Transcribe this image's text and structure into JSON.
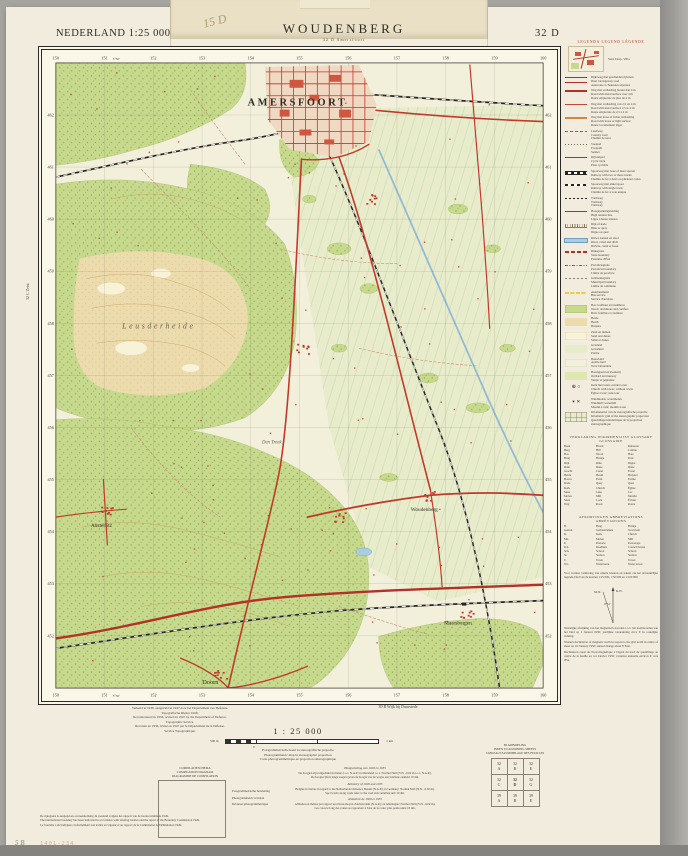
{
  "page": {
    "stamp": "1401-234",
    "pencil_mark": "5 B"
  },
  "header": {
    "series": "NEDERLAND 1:25 000",
    "title": "WOUDENBERG",
    "subtitle": "32 D  Amersfoort",
    "sheet": "32 D",
    "scribble": "15 D"
  },
  "map": {
    "grid_top": [
      "150",
      "151",
      "152",
      "153",
      "154",
      "155",
      "156",
      "157",
      "158",
      "159",
      "160"
    ],
    "grid_left": [
      "462",
      "461",
      "460",
      "459",
      "458",
      "457",
      "456",
      "455",
      "454",
      "453",
      "452"
    ],
    "neighbor_left": "32 C  Zeist",
    "labels": [
      {
        "t": "AMERSFOORT",
        "x": 258,
        "y": 56,
        "c": "city"
      },
      {
        "t": "Leusderheide",
        "x": 118,
        "y": 280,
        "c": "area"
      },
      {
        "t": "Den Treek",
        "x": 232,
        "y": 396,
        "c": "estate"
      },
      {
        "t": "Austerlitz",
        "x": 60,
        "y": 480,
        "c": "town"
      },
      {
        "t": "Woudenberg",
        "x": 386,
        "y": 464,
        "c": "town"
      },
      {
        "t": "Maarsbergen",
        "x": 420,
        "y": 578,
        "c": "town"
      },
      {
        "t": "Doorn",
        "x": 170,
        "y": 638,
        "c": "town2"
      },
      {
        "t": "5°30'",
        "x": 75,
        "y": 10,
        "c": "mer"
      },
      {
        "t": "5°30'",
        "x": 75,
        "y": 651,
        "c": "mer"
      }
    ]
  },
  "legend": {
    "title": "LEGENDA   LEGEND   LÉGENDE",
    "sample_caption": "Stad.  Dorp.  Villa",
    "items": [
      {
        "sym": "road2",
        "lines": [
          "Rijksweg met gescheiden rijbanen",
          "Dual carriageway road",
          "Autoroute à chaussées séparées"
        ]
      },
      {
        "sym": "road1",
        "lines": [
          "Weg met verharding breder dan 4 m",
          "Road with metal surface over 4 m",
          "Route empierrée de plus de 4 m"
        ]
      },
      {
        "sym": "roadm",
        "lines": [
          "Weg met verharding van 2,5 tot 4 m",
          "Road with metal surface 2.5 to 4 m",
          "Route empierrée de 2,5 à 4 m"
        ]
      },
      {
        "sym": "roado",
        "lines": [
          "Weg met losse of lichte verharding",
          "Road with loose or light surface",
          "Route à revêtement léger"
        ]
      },
      {
        "sym": "dash",
        "lines": [
          "Landweg",
          "Country road",
          "Chemin de terre"
        ]
      },
      {
        "sym": "dots",
        "lines": [
          "Voetpad",
          "Footpath",
          "Sentier"
        ]
      },
      {
        "sym": "thin",
        "lines": [
          "Rijwielpad",
          "Cycle track",
          "Piste cyclable"
        ]
      },
      {
        "sym": "rail2",
        "lines": [
          "Spoorweg met twee of meer sporen",
          "Railway with two or more tracks",
          "Chemin de fer à deux ou plusieurs voies"
        ]
      },
      {
        "sym": "rail1",
        "lines": [
          "Spoorweg met enkel spoor",
          "Railway with single track",
          "Chemin de fer à voie unique"
        ]
      },
      {
        "sym": "tram",
        "lines": [
          "Tramweg",
          "Tramway",
          "Tramway"
        ]
      },
      {
        "sym": "power",
        "lines": [
          "Hoogspanningsleiding",
          "High tension line",
          "Ligne à haute tension"
        ]
      },
      {
        "sym": "dyke",
        "lines": [
          "Dijk of kade",
          "Dike or quay",
          "Digue ou quai"
        ]
      },
      {
        "sym": "water",
        "lines": [
          "Rivier, kanaal en sloot",
          "River, canal and ditch",
          "Rivière, canal et fossé"
        ]
      },
      {
        "sym": "bred",
        "lines": [
          "Rijksgrens",
          "State boundary",
          "Frontière d'État"
        ]
      },
      {
        "sym": "bprov",
        "lines": [
          "Provinciegrens",
          "Provincial boundary",
          "Limite de province"
        ]
      },
      {
        "sym": "bgem",
        "lines": [
          "Gemeentegrens",
          "Municipal boundary",
          "Limite de commune"
        ]
      },
      {
        "sym": "yellow",
        "lines": [
          "Autobusdienst",
          "Bus service",
          "Service d'autobus"
        ]
      },
      {
        "sym": "agreen",
        "lines": [
          "Bos: loofhout en naaldhout",
          "Wood: deciduous and conifers",
          "Bois: feuillus et conifères"
        ]
      },
      {
        "sym": "aheath",
        "lines": [
          "Heide",
          "Heath",
          "Bruyère"
        ]
      },
      {
        "sym": "asand",
        "lines": [
          "Zand en duinen",
          "Sand and dunes",
          "Sable et dunes"
        ]
      },
      {
        "sym": "agrass",
        "lines": [
          "Grasland",
          "Grassland",
          "Prairie"
        ]
      },
      {
        "sym": "aarable",
        "lines": [
          "Bouwland",
          "Arable land",
          "Terre labourable"
        ]
      },
      {
        "sym": "aorchard",
        "lines": [
          "Boomgaard en kwekerij",
          "Orchard and nursery",
          "Verger et pépinière"
        ]
      },
      {
        "sym": "church",
        "lines": [
          "Kerk met toren; zonder toren",
          "Church with tower; without tower",
          "Église à tour; sans tour"
        ]
      },
      {
        "sym": "mill",
        "lines": [
          "Windmolen; watermolen",
          "Windmill; watermill",
          "Moulin à vent; moulin à eau"
        ]
      },
      {
        "sym": "sgrid",
        "lines": [
          "Kilometernet van de stereografische projectie",
          "Kilometric grid of the stereographic projection",
          "Quadrillage kilométrique de la projection stéréographique"
        ]
      }
    ],
    "glossary_title": "VERKLARING   WOORDENLIJST   GLOSSARY   GLOSSAIRE",
    "glossary": [
      [
        "Beek",
        "Brook",
        "Ruisseau"
      ],
      [
        "Berg",
        "Hill",
        "Colline"
      ],
      [
        "Bos",
        "Wood",
        "Bois"
      ],
      [
        "Brug",
        "Bridge",
        "Pont"
      ],
      [
        "Dijk",
        "Dike",
        "Digue"
      ],
      [
        "Duin",
        "Dune",
        "Dune"
      ],
      [
        "Gracht",
        "Canal",
        "Fossé"
      ],
      [
        "Heide",
        "Heath",
        "Bruyère"
      ],
      [
        "Hoeve",
        "Farm",
        "Ferme"
      ],
      [
        "Kade",
        "Quay",
        "Quai"
      ],
      [
        "Kerk",
        "Church",
        "Église"
      ],
      [
        "Meer",
        "Lake",
        "Lac"
      ],
      [
        "Molen",
        "Mill",
        "Moulin"
      ],
      [
        "Sluis",
        "Lock",
        "Écluse"
      ],
      [
        "Weg",
        "Road",
        "Route"
      ]
    ],
    "abbrev_title": "AFKORTINGEN   ABBREVIATIONS   ABRÉVIATIONS",
    "abbrev": [
      [
        "B.",
        "Brug",
        "Bridge"
      ],
      [
        "Gem.h.",
        "Gemeentehuis",
        "Town hall"
      ],
      [
        "K.",
        "Kerk",
        "Church"
      ],
      [
        "Mn.",
        "Molen",
        "Mill"
      ],
      [
        "P.",
        "Pastorie",
        "Parsonage"
      ],
      [
        "R.h.",
        "Raadhuis",
        "Council house"
      ],
      [
        "Sch.",
        "School",
        "School"
      ],
      [
        "St.",
        "Station",
        "Station"
      ],
      [
        "T.",
        "Toren",
        "Tower"
      ],
      [
        "W.t.",
        "Watertoren",
        "Water tower"
      ]
    ],
    "note": "Voor verdere verklaring van enkele kleuren en tekens zie het afzonderlijke legenda-blad van de kaarten 1:25 000, 1:50 000 en 1:100 000.",
    "declination": {
      "kn": "K.N.",
      "mn": "M.N.",
      "angle": "0°51'",
      "nl": "Westelijke afwijking van het magnetisch noorden t.o.v. het kaartnoorden van het blad op 1 Januari 1950; jaarlijkse verandering circa 6' in oostelijke richting.",
      "en": "Western declination of magnetic north in regard to the grid north in centre of sheet on 1st January 1950; annual change about 6' East.",
      "fr": "Déclinaison ouest du Nord magnétique à l'égard du nord du quadrillage au centre de la feuille au 1er Janvier 1950; variation annuelle environ 6' vers l'Est."
    }
  },
  "footer": {
    "production": [
      "Verkend in 1936, aangevuld in 1947 door het Departement van Defensie.",
      "Topografische Dienst, Delft.",
      "Reconnoitered in 1936, revised in 1947 by the Department of Defence.",
      "Topographic Service.",
      "Reconnu en 1936, révisé en 1947 par le Département de la Défense.",
      "Service Topographique."
    ],
    "neighbor_bottom": "39 B  Wijk bij Duurstede",
    "scale_label": "1 : 25 000",
    "scale_left": "500 m",
    "scale_zero": "0",
    "scale_right": "1 km",
    "projection": [
      "Fotogrammetrische kaart in stereografische projectie",
      "Photogrammetric map in stereographic projection",
      "Carte photogrammétrique en projection stéréographique"
    ],
    "compilation_title": [
      "COMPILATIESCHEMA",
      "COMPILATION DIAGRAM",
      "DIAGRAMME DE COMPILATION"
    ],
    "compilation_labels": [
      "Fotogrammetrische herziening",
      "Photogrammetric revision",
      "Révision photogrammétrique"
    ],
    "altimetry": [
      {
        "h": "Hoogtemeting van 1926 en 1935",
        "lines": [
          "De hoogten zijn uitgedrukt in meters t.o.v. N.A.P.; in Duitsland t.o.v. Normal Null (N.N. -0,02 m t.o.v. N.A.P.).",
          "De hoogtecijfers langs wegen geven de hoogte van de wegas aan; kleinste eenheid 10 dm."
        ]
      },
      {
        "h": "Altimetry of 1926 and 1935",
        "lines": [
          "Heights in metres in regard to the Netherlands Ordnance Datum (N.A.P.); in Germany: Normal Null (N.N. -0.02 m).",
          "Spot levels along roads refer to the road axis; smallest unit 10 dm."
        ]
      },
      {
        "h": "Altimétrie de 1926 et 1935",
        "lines": [
          "Altitudes en mètres par rapport au niveau moyen d'Amsterdam (N.A.P.); en Allemagne: Normal Null (N.N. -0,02 m).",
          "Les cotes le long des routes se rapportent à l'axe de la route; plus petite unité 10 dm."
        ]
      }
    ],
    "boundary_note": [
      "De rijksgrens is aangegeven overeenkomstig de toestand volgens het rapport van de Grenscommissie 1949.",
      "The international boundary has been indicated in accordance with existing treaties and the report of the Boundary Commission 1949.",
      "La frontière a été indiquée conformément aux traités en vigueur et au rapport de la Commission de Délimitation 1949."
    ],
    "index": {
      "titles": [
        "BLADINDELING",
        "INDEX TO ADJOINING SHEETS",
        "TABLEAU D'ASSEMBLAGE DES FEUILLES"
      ],
      "cells": [
        [
          [
            "32",
            "A"
          ],
          [
            "32",
            "B"
          ],
          [
            "32",
            "E"
          ]
        ],
        [
          [
            "32",
            "C"
          ],
          [
            "32",
            "D"
          ],
          [
            "32",
            "G"
          ]
        ],
        [
          [
            "39",
            "A"
          ],
          [
            "39",
            "B"
          ],
          [
            "39",
            "E"
          ]
        ]
      ]
    }
  }
}
